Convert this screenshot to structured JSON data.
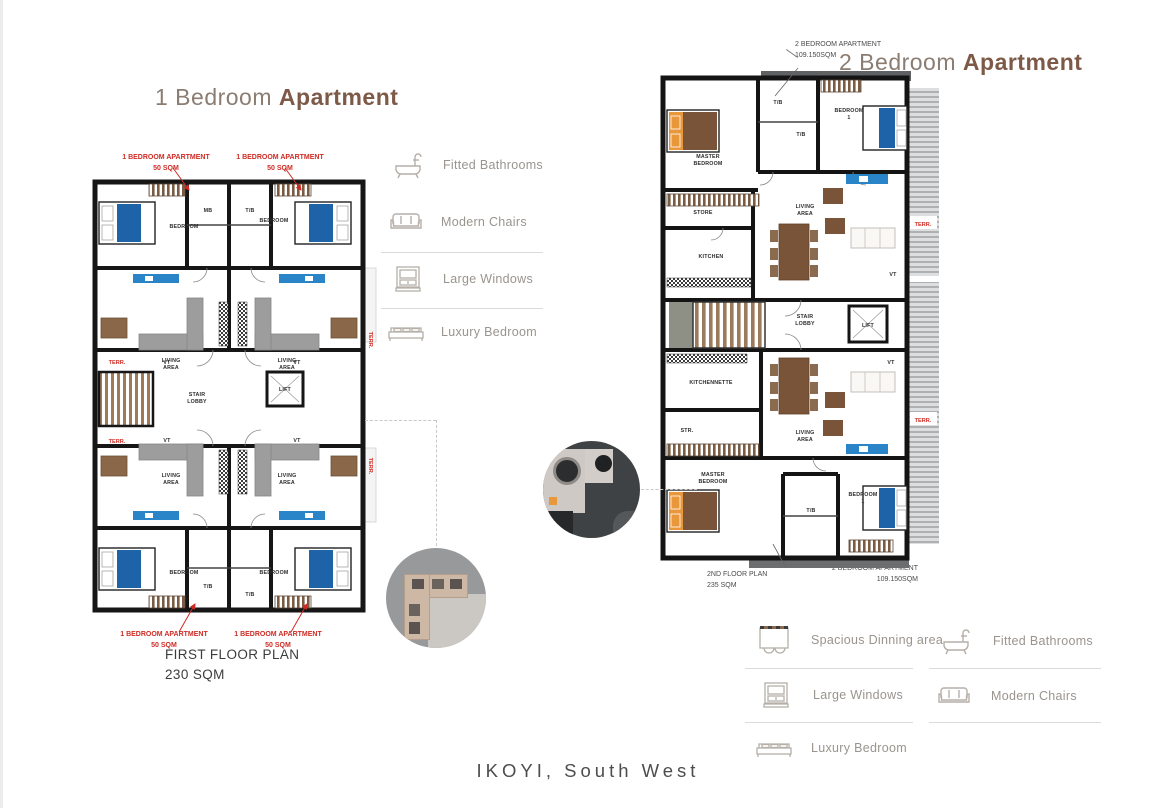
{
  "plans": {
    "one_bed": {
      "title_light": "1 Bedroom",
      "title_bold": "Apartment",
      "unit_label_line1": "1 BEDROOM APARTMENT",
      "unit_label_line2": "50 SQM",
      "floor_name": "FIRST FLOOR PLAN",
      "floor_area": "230 SQM",
      "rooms": {
        "bedroom": "BEDROOM",
        "mb": "MB",
        "tb": "T/B",
        "vt": "VT",
        "living1": "LIVING",
        "living2": "AREA",
        "stair1": "STAIR",
        "stair2": "LOBBY",
        "lift": "LIFT",
        "terr": "TERR."
      }
    },
    "two_bed": {
      "title_light": "2 Bedroom",
      "title_bold": "Apartment",
      "unit_label_line1": "2 BEDROOM APARTMENT",
      "unit_label_line2": "109.150SQM",
      "floor_name": "2ND FLOOR PLAN",
      "floor_area": "235 SQM",
      "rooms": {
        "master1": "MASTER",
        "master2": "BEDROOM",
        "bedroom": "BEDROOM",
        "bedroom_no": "1",
        "store": "STORE",
        "kitchen": "KITCHEN",
        "kitchennette": "KITCHENNETTE",
        "str": "STR.",
        "stair1": "STAIR",
        "stair2": "LOBBY",
        "lift": "LIFT",
        "living1": "LIVING",
        "living2": "AREA",
        "tb": "T/B",
        "vt": "VT",
        "terr": "TERR."
      }
    }
  },
  "legend_side": {
    "items": [
      {
        "icon": "bathtub-icon",
        "label": "Fitted Bathrooms"
      },
      {
        "icon": "sofa-icon",
        "label": "Modern Chairs"
      },
      {
        "icon": "window-icon",
        "label": "Large Windows"
      },
      {
        "icon": "bed-icon",
        "label": "Luxury Bedroom"
      }
    ]
  },
  "legend_bottom": {
    "left": [
      {
        "icon": "dining-table-icon",
        "label": "Spacious Dinning area"
      },
      {
        "icon": "window-icon",
        "label": "Large Windows"
      },
      {
        "icon": "bed-icon",
        "label": "Luxury Bedroom"
      }
    ],
    "right": [
      {
        "icon": "bathtub-icon",
        "label": "Fitted Bathrooms"
      },
      {
        "icon": "sofa-icon",
        "label": "Modern Chairs"
      }
    ]
  },
  "footer": {
    "location": "IKOYI, South West"
  },
  "colors": {
    "title_light": "#8b7d72",
    "title_bold": "#7d5a47",
    "red_label": "#cf2b24",
    "wall": "#161616",
    "bed_blue": "#1e62a8",
    "tv_blue": "#2a84c8",
    "furniture_brown": "#7a5438",
    "armchair_brown": "#8a6748",
    "sofa_gray": "#9d9d9d",
    "bed_orange": "#e8973a",
    "legend_text": "#9a948e",
    "footer_text": "#4d4d4d"
  }
}
